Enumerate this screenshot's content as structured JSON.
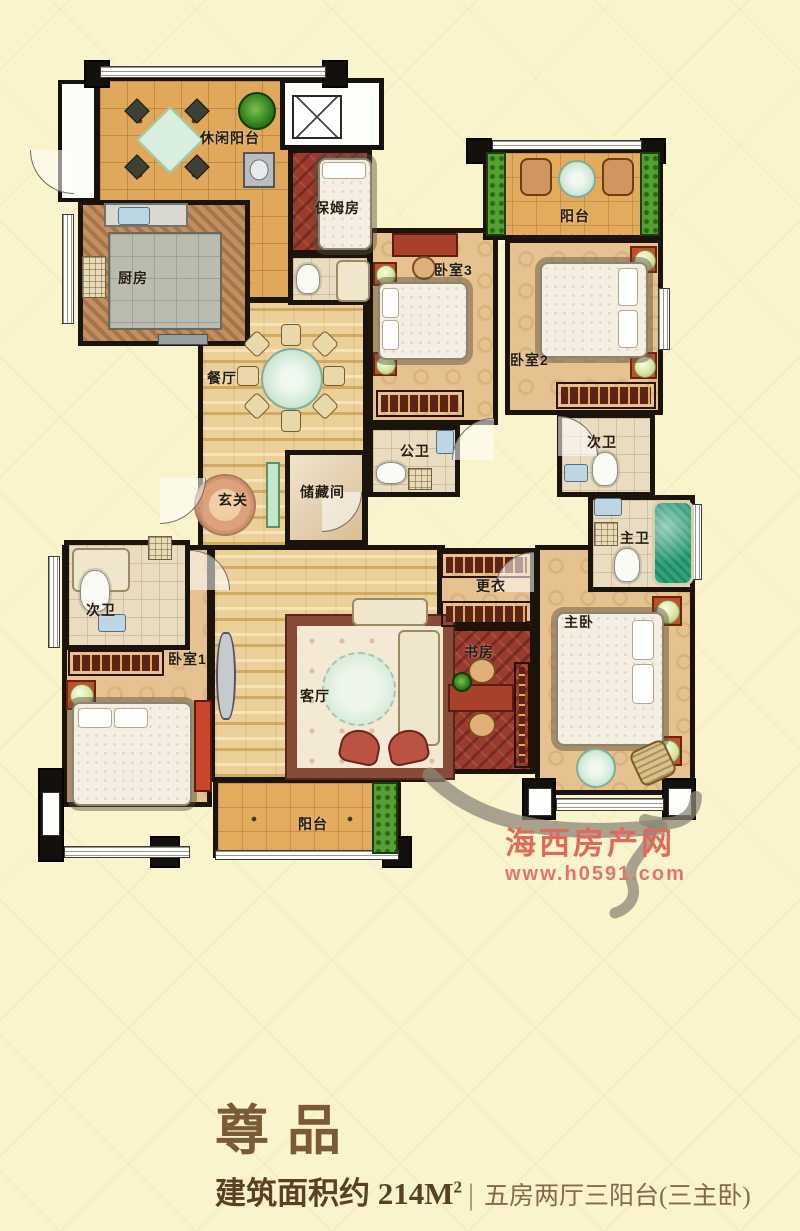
{
  "colors": {
    "page_background": "#f9f4cb",
    "wall": "#1b140d",
    "floor_tile": "#e0a85a",
    "floor_red_carpet": "#9a3b2e",
    "watermark_red": "#df6a5c",
    "caption_brown": "#5a4126"
  },
  "floorplan": {
    "rooms": [
      {
        "id": "leisure-balcony",
        "label": "休闲阳台"
      },
      {
        "id": "kitchen",
        "label": "厨房"
      },
      {
        "id": "nanny-room",
        "label": "保姆房"
      },
      {
        "id": "balcony-top",
        "label": "阳台"
      },
      {
        "id": "bedroom-3",
        "label": "卧室3"
      },
      {
        "id": "bedroom-2",
        "label": "卧室2"
      },
      {
        "id": "dining-room",
        "label": "餐厅"
      },
      {
        "id": "foyer",
        "label": "玄关"
      },
      {
        "id": "storage-room",
        "label": "储藏间"
      },
      {
        "id": "public-bathroom",
        "label": "公卫"
      },
      {
        "id": "second-bathroom-right",
        "label": "次卫"
      },
      {
        "id": "master-bathroom",
        "label": "主卫"
      },
      {
        "id": "second-bathroom-left",
        "label": "次卫"
      },
      {
        "id": "bedroom-1",
        "label": "卧室1"
      },
      {
        "id": "living-room",
        "label": "客厅"
      },
      {
        "id": "dressing-room",
        "label": "更衣"
      },
      {
        "id": "study",
        "label": "书房"
      },
      {
        "id": "master-bedroom",
        "label": "主卧"
      },
      {
        "id": "balcony-bottom",
        "label": "阳台"
      }
    ]
  },
  "watermark": {
    "site_name": "海西房产网",
    "site_url": "www.h0591.com"
  },
  "caption": {
    "title": "尊品",
    "area_prefix": "建筑面积约 ",
    "area_value": "214M",
    "area_sup": "2",
    "divider": "|",
    "layout_desc": "五房两厅三阳台(三主卧)"
  }
}
